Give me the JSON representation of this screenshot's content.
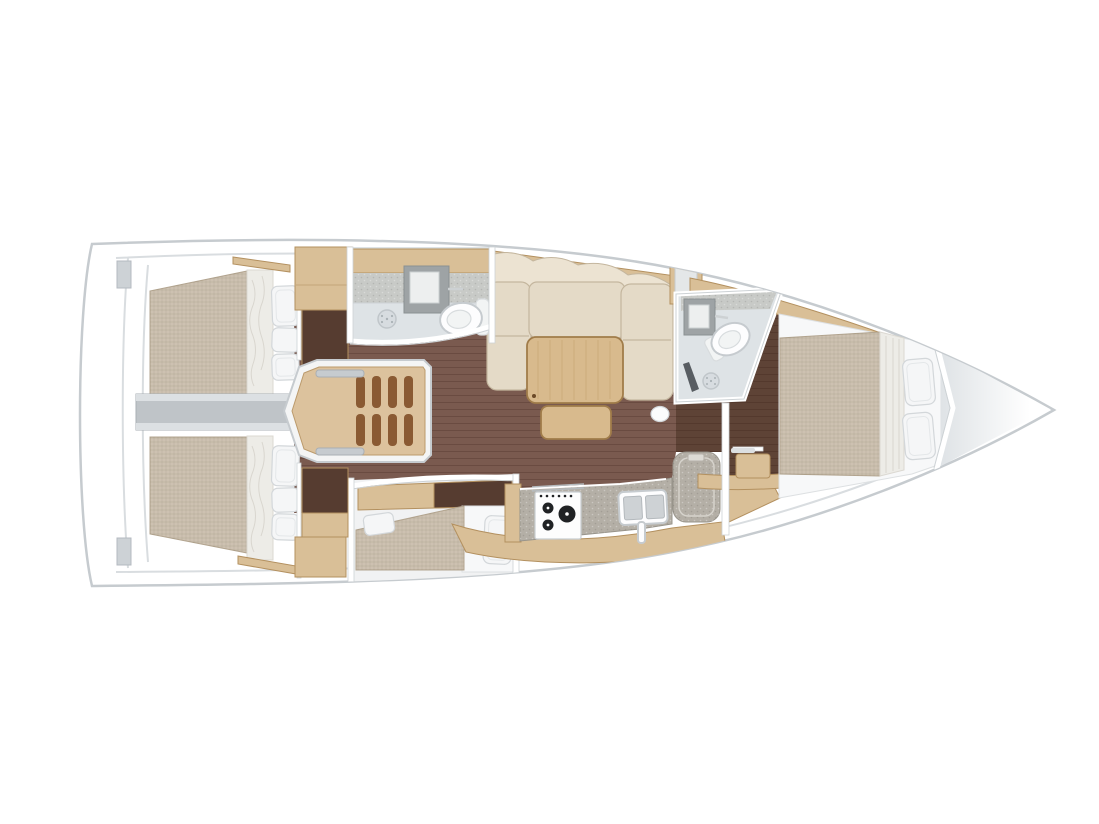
{
  "floorplan": {
    "vessel": "sailing-yacht-interior-layout-top-view",
    "orientation": "bow-right",
    "rooms": [
      {
        "name": "aft-cabin-port",
        "fixtures": [
          "double-berth",
          "three-pillows",
          "hanging-locker",
          "deck-hatch"
        ]
      },
      {
        "name": "aft-cabin-starboard",
        "fixtures": [
          "double-berth",
          "three-pillows",
          "hanging-locker",
          "seat-locker"
        ]
      },
      {
        "name": "engine-compartment",
        "fixtures": [
          "center-beam"
        ]
      },
      {
        "name": "companionway",
        "fixtures": [
          "wooden-stairs-four-treads",
          "two-grab-rails"
        ]
      },
      {
        "name": "aft-head",
        "fixtures": [
          "washbasin",
          "toilet",
          "shower-drain",
          "overhead-locker"
        ]
      },
      {
        "name": "saloon",
        "fixtures": [
          "l-shaped-sofa",
          "dining-table",
          "bench-seat",
          "pouf",
          "hull-side-shelf"
        ]
      },
      {
        "name": "galley",
        "fixtures": [
          "stove-three-burners",
          "double-sink",
          "refrigerator",
          "worktop",
          "lower-cabinets"
        ]
      },
      {
        "name": "third-cabin",
        "fixtures": [
          "berth",
          "two-pillows",
          "overhead-locker"
        ]
      },
      {
        "name": "forward-head",
        "fixtures": [
          "washbasin",
          "toilet",
          "shower-drain",
          "shower-handle"
        ]
      },
      {
        "name": "forward-cabin",
        "fixtures": [
          "island-double-berth",
          "two-pillows",
          "vanity-desk",
          "seat"
        ]
      },
      {
        "name": "bow-locker",
        "fixtures": []
      }
    ]
  },
  "colors": {
    "background": "#ffffff",
    "hull_outline": "#c6cbcf",
    "inner_line": "#d9dde0",
    "floor": "#7a5a4f",
    "floor_dark": "#5e4336",
    "locker_dark": "#563c30",
    "wood": "#d9bf97",
    "wood_edge": "#b3905f",
    "mattress": "#cdc1b1",
    "mattress_edge": "#b3a590",
    "linen": "#edece7",
    "pillow": "#f5f6f7",
    "pillow_edge": "#d3d7da",
    "cushion": "#e4dac7",
    "cushion_back": "#ece3d2",
    "cushion_seam": "#c4b69e",
    "table_wood": "#d8ba8d",
    "table_edge": "#a07c4a",
    "stairs_wood": "#dcc29d",
    "stairs_rung": "#8a5a33",
    "bath_floor": "#dee3e6",
    "bath_wall": "#c8cac7",
    "fixture": "#9ea3a5",
    "fixture_edge": "#c6cbcf",
    "white_fixture": "#fdfdfe",
    "counter": "#b4afa6",
    "counter_edge": "#98948b",
    "beam": "#bfc4c8",
    "beam_light": "#dce0e3",
    "wall_edge": "#cdd2d5",
    "bow_shade": "#dfe3e6",
    "burner": "#202224",
    "wand": "#585d62",
    "step_gray": "#cdd2d6"
  }
}
